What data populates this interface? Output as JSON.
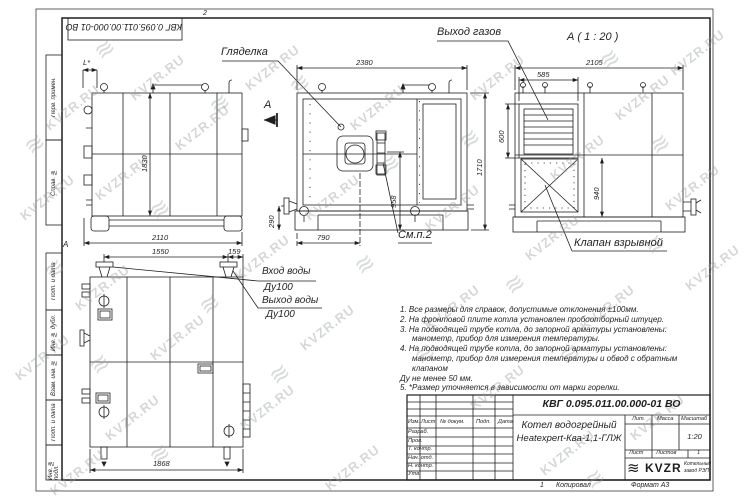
{
  "sheet": {
    "zone_top": "2",
    "zone_bottom_num": "1",
    "zone_left": "А",
    "stamp_number": "КВГ 0.095.011.00.000-01 ВО",
    "margin_labels": [
      "Перв. примен.",
      "Справ. №",
      "Подп. и дата",
      "Инв. № дубл.",
      "Взам. инв. №",
      "Подп. и дата",
      "Инв. № подл."
    ],
    "footer": {
      "copy": "Копировал",
      "format": "Формат А3"
    }
  },
  "watermark": {
    "text": "KVZR.RU",
    "logo": "≋"
  },
  "drawing": {
    "labels": {
      "sight_glass": "Гляделка",
      "gas_outlet": "Выход газов",
      "section_view_title": "А ( 1 : 20 )",
      "section_arrow": "А",
      "see_note": "См.п.2",
      "explosion_valve": "Клапан взрывной",
      "water_inlet": "Вход воды",
      "water_inlet_dn": "Ду100",
      "water_outlet": "Выход воды",
      "water_outlet_dn": "Ду100"
    },
    "dims": {
      "side_top": "L*",
      "side_height": "1830",
      "side_width": "2110",
      "front_width": "2380",
      "front_height": "1710",
      "burner_height": "958",
      "stub_height": "290",
      "burner_offset": "790",
      "section_width": "2105",
      "louver_width": "585",
      "louver_height": "600",
      "valve_height": "940",
      "rear_pipes_span": "1550",
      "rear_pipe_edge": "159",
      "rear_width": "1868"
    }
  },
  "notes": {
    "lines": [
      "1. Все размеры для справок, допустимые отклонения ±100мм.",
      "2. На фронтовой плите котла установлен пробоотборный штуцер.",
      "3. На подводящей трубе котла, до запорной арматуры установлены:",
      "манометр, прибор для измерения температуры.",
      "4. На подводящей трубе котла, до запорной арматуры установлены:",
      "манометр, прибор для измерения температуры и обвод с обратным клапаном",
      "Ду не менее 50 мм.",
      "5. *Размер уточняется в зависимости от марки горелки."
    ]
  },
  "title_block": {
    "doc_number": "КВГ 0.095.011.00.000-01 ВО",
    "product_line1": "Котел водогрейный",
    "product_line2": "Heatexpert-Ква-1,1-ГЛЖ",
    "col_headers": {
      "izm": "Изм.",
      "list": "Лист",
      "doc": "№ докум.",
      "sign": "Подп.",
      "date": "Дата"
    },
    "row_labels": [
      "Разраб.",
      "Пров.",
      "Т. контр.",
      "Нач. отд.",
      "Н. контр.",
      "Утв."
    ],
    "lit_header": "Лит.",
    "mass_header": "Масса",
    "scale_header": "Масштаб",
    "scale_value": "1:20",
    "sheet_label": "Лист",
    "sheets_label": "Листов",
    "sheets_value": "1",
    "logo_text": "KVZR",
    "logo_glyph": "≋",
    "company_line1": "Котельный",
    "company_line2": "завод РЭП"
  }
}
